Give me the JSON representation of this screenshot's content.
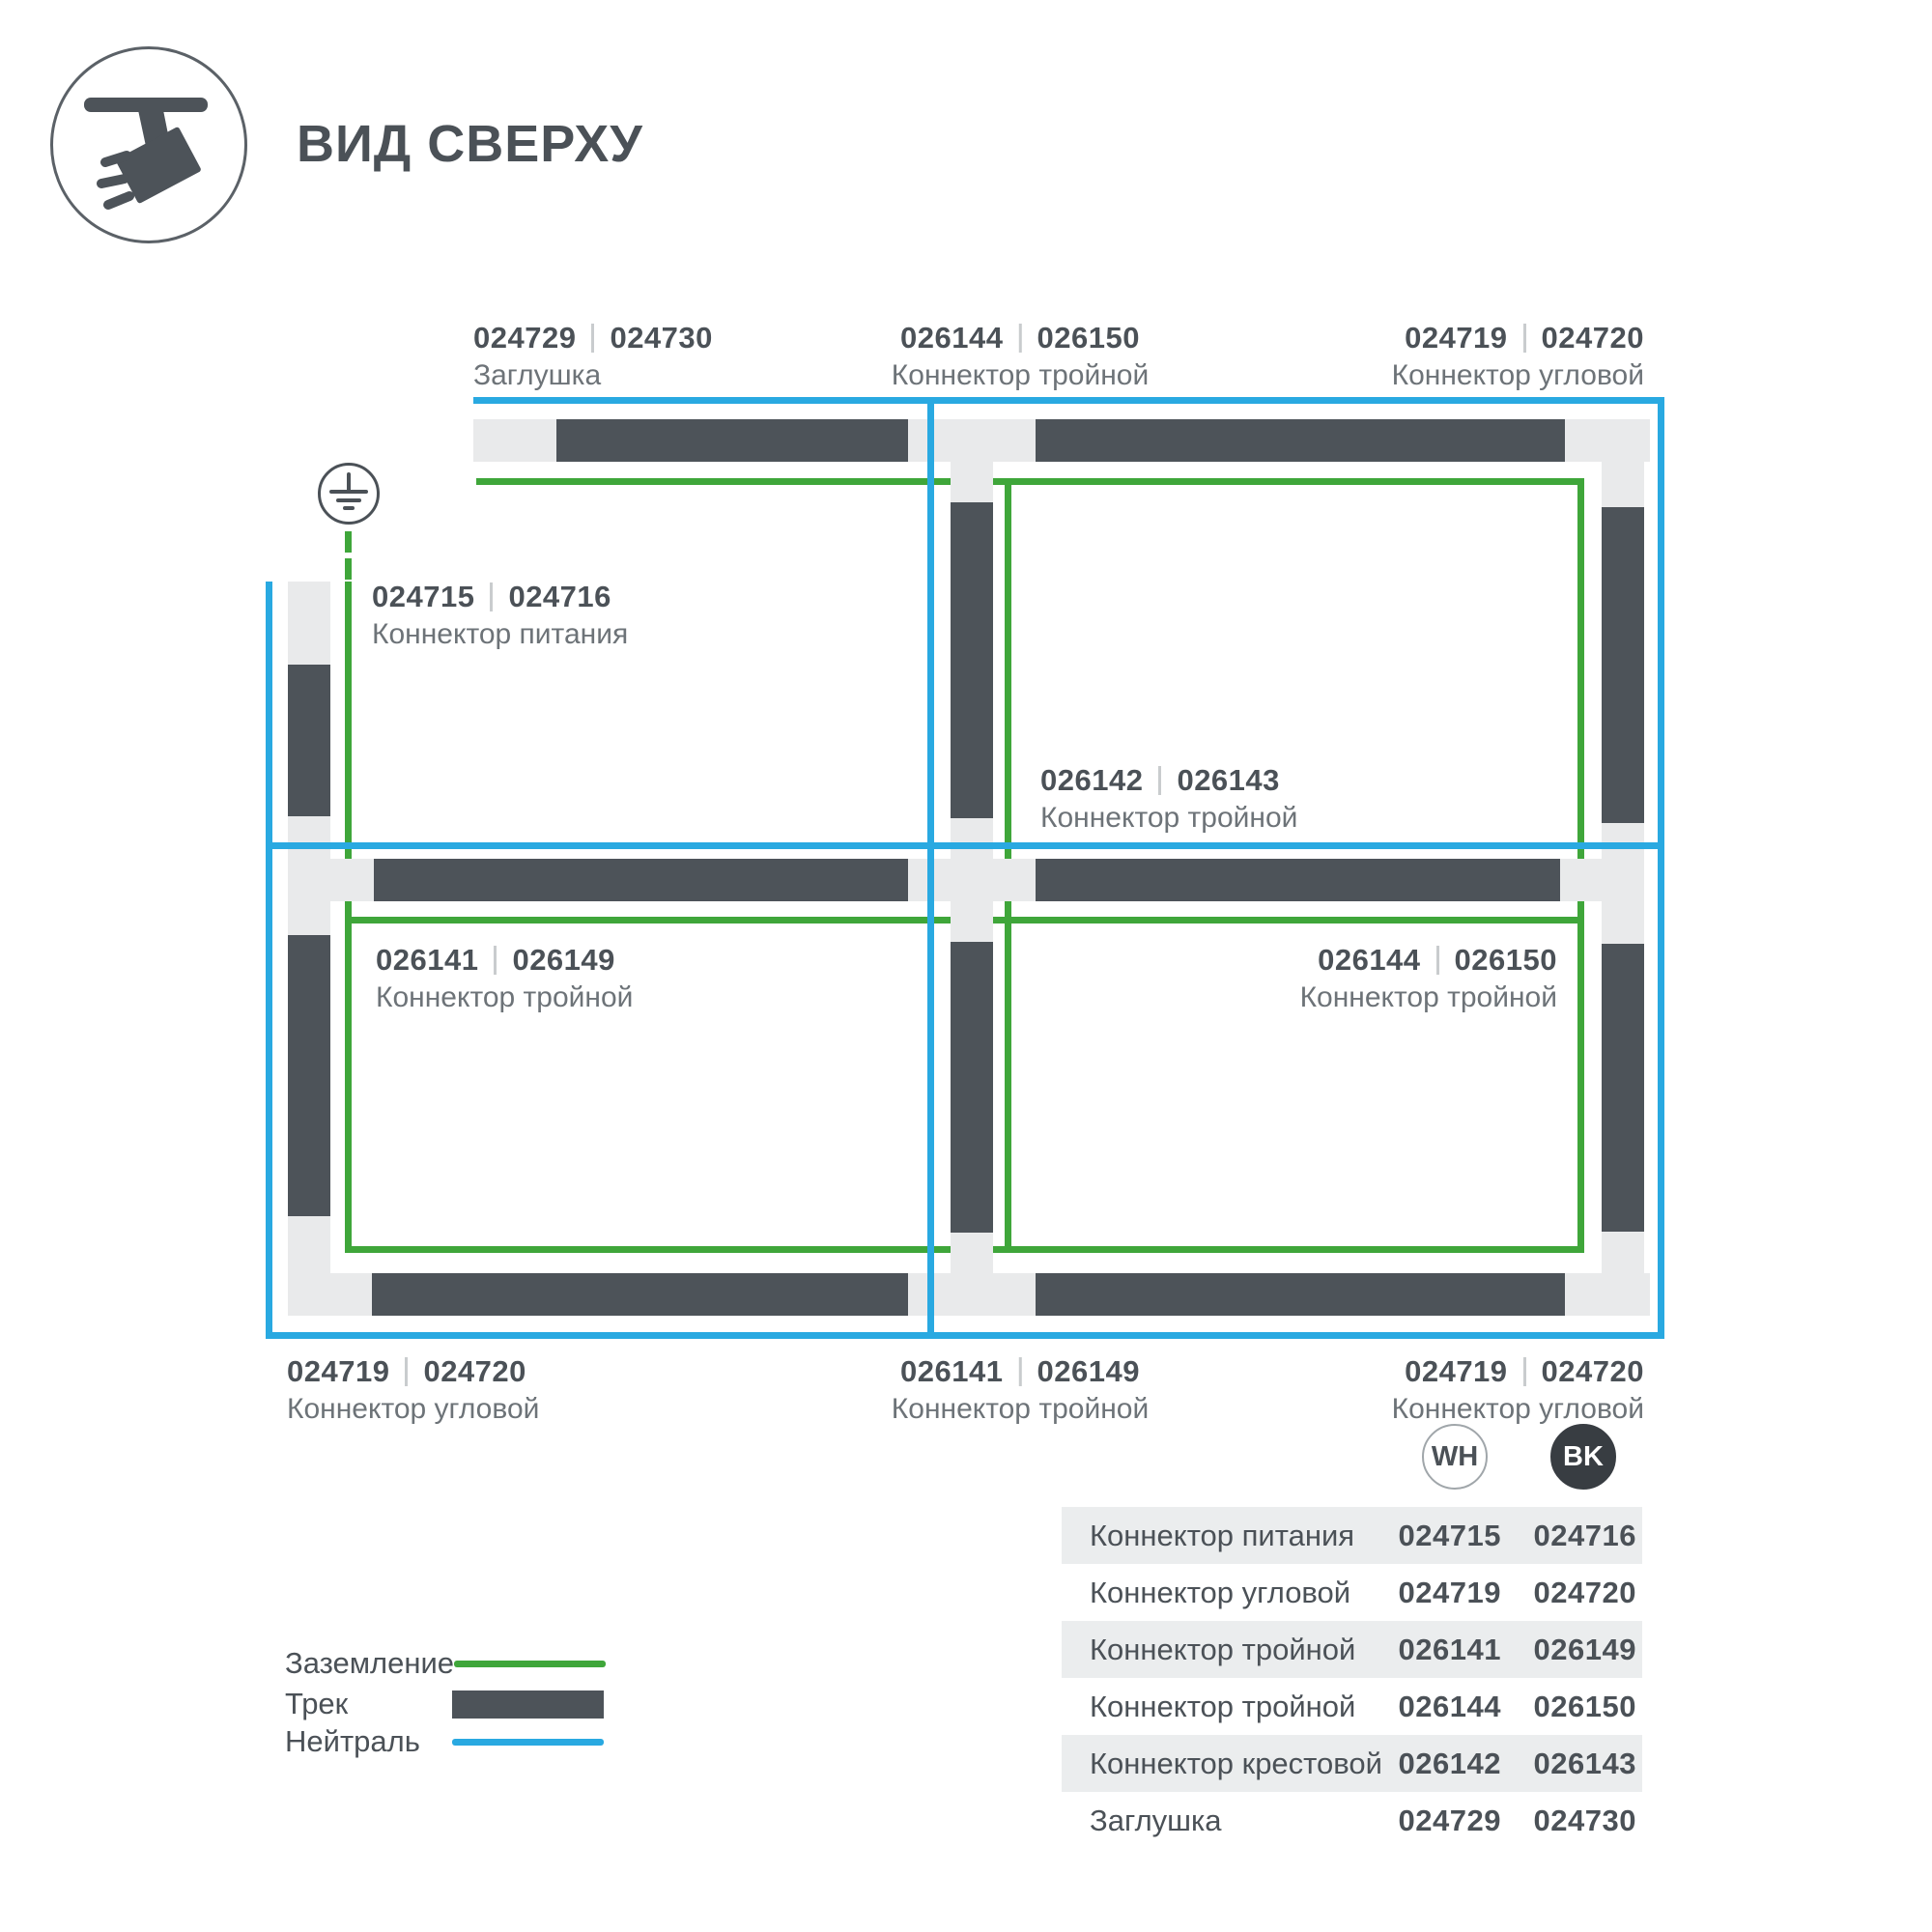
{
  "title": "ВИД СВЕРХУ",
  "icons": {
    "header": "track-spotlight-icon",
    "diagram": "earth-ground-icon"
  },
  "colors": {
    "track": "#4d5359",
    "pad": "#e9eaeb",
    "ground": "#3fa63a",
    "neutral": "#29a9e1",
    "stripe": "#ebedee",
    "text-dark": "#4b5157",
    "text-muted": "#6d7378",
    "divider": "#c9ccce",
    "bk-fill": "#383d42"
  },
  "diagram": {
    "labels": [
      {
        "pos": "top-end-cap",
        "wh": "024729",
        "bk": "024730",
        "name": "Заглушка"
      },
      {
        "pos": "top-tee",
        "wh": "026144",
        "bk": "026150",
        "name": "Коннектор тройной"
      },
      {
        "pos": "top-corner",
        "wh": "024719",
        "bk": "024720",
        "name": "Коннектор угловой"
      },
      {
        "pos": "power-feed",
        "wh": "024715",
        "bk": "024716",
        "name": "Коннектор питания"
      },
      {
        "pos": "center-cross",
        "wh": "026142",
        "bk": "026143",
        "name": "Коннектор тройной"
      },
      {
        "pos": "cell-bottom-left",
        "wh": "026141",
        "bk": "026149",
        "name": "Коннектор тройной"
      },
      {
        "pos": "cell-bottom-right",
        "wh": "026144",
        "bk": "026150",
        "name": "Коннектор тройной"
      },
      {
        "pos": "bottom-corner-left",
        "wh": "024719",
        "bk": "024720",
        "name": "Коннектор угловой"
      },
      {
        "pos": "bottom-tee",
        "wh": "026141",
        "bk": "026149",
        "name": "Коннектор тройной"
      },
      {
        "pos": "bottom-corner-right",
        "wh": "024719",
        "bk": "024720",
        "name": "Коннектор угловой"
      }
    ]
  },
  "legend": {
    "items": [
      {
        "label": "Заземление",
        "swatch": "ground-line"
      },
      {
        "label": "Трек",
        "swatch": "track-bar"
      },
      {
        "label": "Нейтраль",
        "swatch": "neutral-line"
      }
    ]
  },
  "table": {
    "columns": [
      {
        "label": "WH"
      },
      {
        "label": "BK"
      }
    ],
    "rows": [
      {
        "name": "Коннектор питания",
        "wh": "024715",
        "bk": "024716"
      },
      {
        "name": "Коннектор угловой",
        "wh": "024719",
        "bk": "024720"
      },
      {
        "name": "Коннектор тройной",
        "wh": "026141",
        "bk": "026149"
      },
      {
        "name": "Коннектор тройной",
        "wh": "026144",
        "bk": "026150"
      },
      {
        "name": "Коннектор крестовой",
        "wh": "026142",
        "bk": "026143"
      },
      {
        "name": "Заглушка",
        "wh": "024729",
        "bk": "024730"
      }
    ]
  }
}
